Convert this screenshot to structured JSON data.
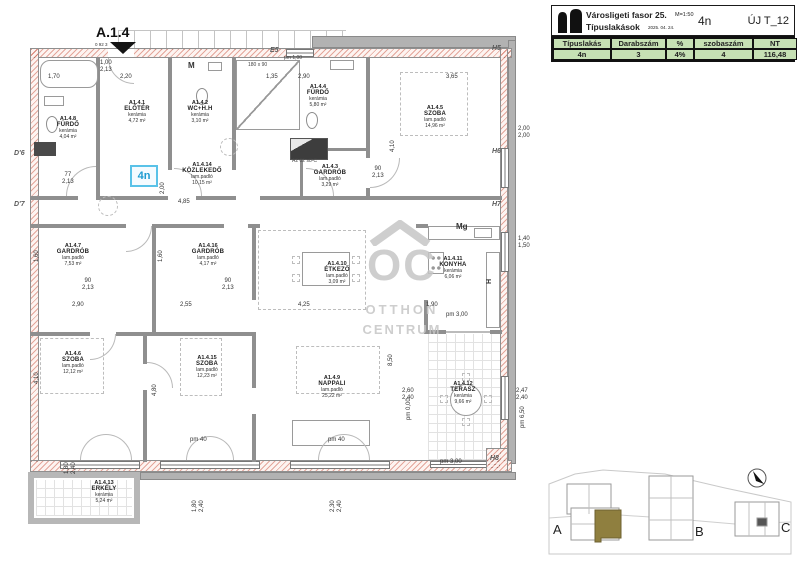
{
  "title_block": {
    "project": "Városligeti fasor 25.",
    "scale": "M=1:50",
    "subtitle": "Típuslakások",
    "date": "2025. 04. 24.",
    "unit_code": "4n",
    "sheet_code": "ÚJ T_12",
    "table_headers": [
      "Típuslakás",
      "Darabszám",
      "%",
      "szobaszám",
      "NT"
    ],
    "table_row": [
      "4n",
      "3",
      "4%",
      "4",
      "116,48"
    ],
    "accent_green": "#c6e0b4"
  },
  "plan": {
    "sheet_label": "A.1.4",
    "sheet_sublabel": "0 92 3",
    "unit_tag": "4n",
    "unit_tag_color": "#1d9bd1",
    "rooms": [
      {
        "code": "A1.4.8",
        "name": "FÜRDŐ",
        "floor": "kerámia",
        "area": "4,04 m²"
      },
      {
        "code": "A1.4.1",
        "name": "ELŐTÉR",
        "floor": "kerámia",
        "area": "4,72 m²"
      },
      {
        "code": "A1.4.2",
        "name": "WC+H.H",
        "floor": "kerámia",
        "area": "3,10 m²"
      },
      {
        "code": "A1.4.4",
        "name": "FÜRDŐ",
        "floor": "kerámia",
        "area": "5,80 m²"
      },
      {
        "code": "A1.4.5",
        "name": "SZOBA",
        "floor": "lam.padló",
        "area": "14,96 m²"
      },
      {
        "code": "A1.4.3",
        "name": "GARDRÓB",
        "floor": "lam.padló",
        "area": "3,29 m²"
      },
      {
        "code": "A1.4.14",
        "name": "KÖZLEKEDŐ",
        "floor": "lam.padló",
        "area": "10,15 m²"
      },
      {
        "code": "A1.4.7",
        "name": "GARDRÓB",
        "floor": "lam.padló",
        "area": "7,53 m²"
      },
      {
        "code": "A1.4.16",
        "name": "GARDRÓB",
        "floor": "lam.padló",
        "area": "4,17 m²"
      },
      {
        "code": "A1.4.10",
        "name": "ÉTKEZŐ",
        "floor": "lam.padló",
        "area": "3,09 m²"
      },
      {
        "code": "A1.4.11",
        "name": "KONYHA",
        "floor": "kerámia",
        "area": "6,06 m²"
      },
      {
        "code": "A1.4.6",
        "name": "SZOBA",
        "floor": "lam.padló",
        "area": "12,12 m²"
      },
      {
        "code": "A1.4.15",
        "name": "SZOBA",
        "floor": "lam.padló",
        "area": "12,23 m²"
      },
      {
        "code": "A1.4.9",
        "name": "NAPPALI",
        "floor": "lam.padló",
        "area": "25,22 m²"
      },
      {
        "code": "A1.4.12",
        "name": "TERASZ",
        "floor": "kerámia",
        "area": "9,66 m²"
      },
      {
        "code": "A1.4.13",
        "name": "ERKÉLY",
        "floor": "kerámia",
        "area": "5,24 m²"
      }
    ],
    "markers": [
      "E5",
      "H5",
      "H6",
      "H7",
      "H8",
      "D'6",
      "D'7",
      "M",
      "Mg",
      "H",
      "A2 02 s8-C",
      "180 x 90",
      "pm 1,00"
    ],
    "dims": [
      "1,70",
      "2,20",
      "1,35",
      "2,90",
      "3,65",
      "4,85",
      "2,90",
      "2,55",
      "4,25",
      "1,90",
      "pm 3,00",
      "pm 40",
      "pm 40",
      "pm 3,00",
      "90\n2,13",
      "90\n2,13",
      "77\n2,13",
      "90\n2,13",
      "2,00\n2,00",
      "1,40\n1,50",
      "2,47\n2,40",
      "2,60\n2,40",
      "1,00\n2,13",
      "4,10",
      "4,10",
      "4,80",
      "8,50",
      "1,60",
      "1,60",
      "2,00",
      "1,80\n2,40",
      "2,30\n2,40",
      "1,80\n2,40",
      "pm 6,50",
      "pm 0,00"
    ]
  },
  "watermark": {
    "monogram": "OC",
    "line1": "OTTHON",
    "line2": "CENTRUM"
  },
  "site_plan": {
    "building_labels": [
      "A",
      "B",
      "C"
    ],
    "highlight_color": "#8f7f3f"
  }
}
